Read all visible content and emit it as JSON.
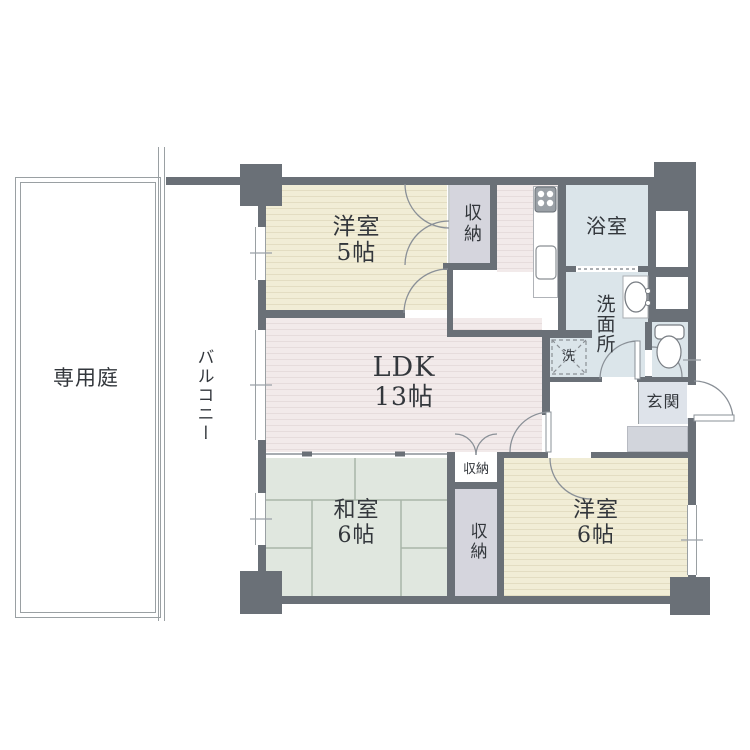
{
  "plan": {
    "colors": {
      "wall": "#6a7077",
      "western_room_floor": "#f1edd6",
      "western_room_stripe": "#e3ddc2",
      "ldk_floor": "#f2eaea",
      "ldk_stripe": "#e6dcdc",
      "tatami_floor": "#e0e7df",
      "tatami_line": "#a9b5a9",
      "wet_area": "#dbe5ea",
      "closet": "#d5d5dd",
      "entrance_step": "#d2d5dc",
      "outline": "#9aa0a3"
    },
    "rooms": {
      "garden": {
        "label": "専用庭"
      },
      "balcony": {
        "label": "バルコニー"
      },
      "western5": {
        "name": "洋室",
        "size": "5帖"
      },
      "ldk": {
        "name": "LDK",
        "size": "13帖"
      },
      "japanese6": {
        "name": "和室",
        "size": "6帖"
      },
      "western6": {
        "name": "洋室",
        "size": "6帖"
      },
      "bath": {
        "label": "浴室"
      },
      "washroom": {
        "label": "洗面所"
      },
      "entrance": {
        "label": "玄関"
      },
      "closet_top": {
        "label": "収納"
      },
      "closet_small": {
        "label": "収納"
      },
      "closet_large": {
        "label": "収納"
      },
      "laundry": {
        "label": "洗"
      }
    }
  }
}
